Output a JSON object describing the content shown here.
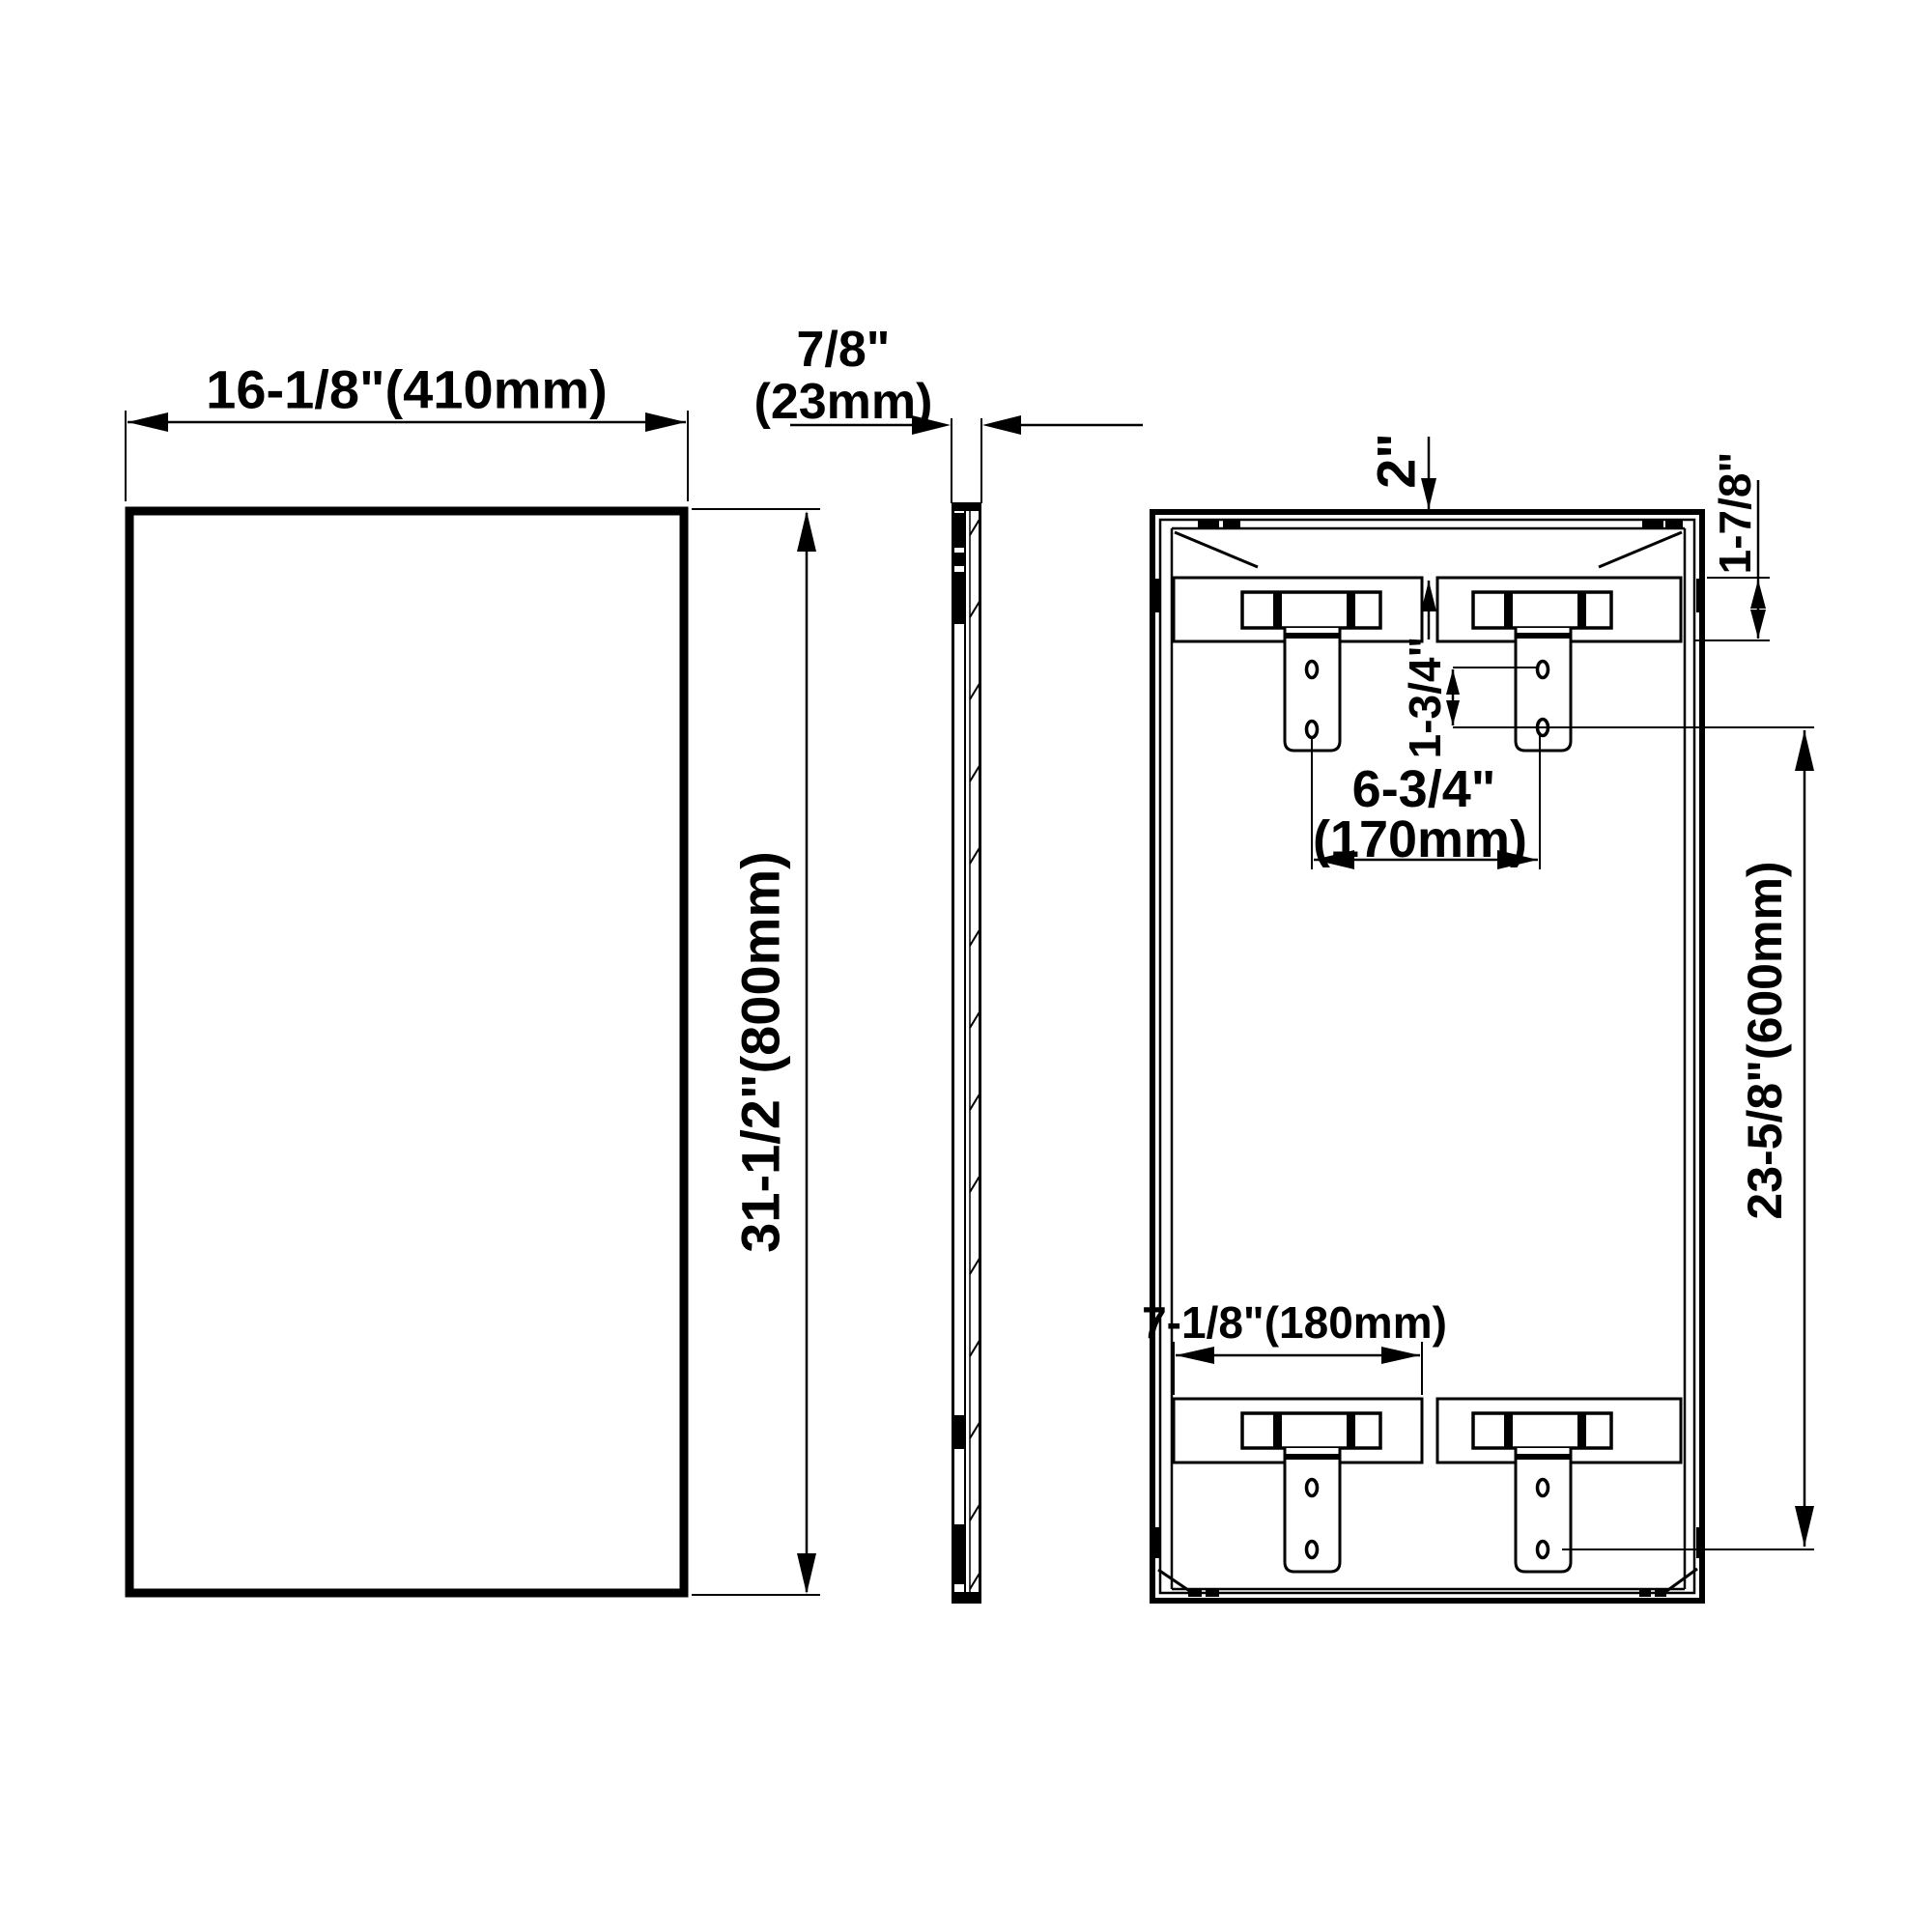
{
  "drawing": {
    "title": "Mirror three-view dimension drawing",
    "colors": {
      "line": "#000000",
      "background": "#ffffff"
    },
    "views": {
      "front": {
        "width_label": "16-1/8\"(410mm)",
        "height_label": "31-1/2\"(800mm)"
      },
      "side": {
        "depth_label_in": "7/8\"",
        "depth_label_mm": "(23mm)"
      },
      "back": {
        "top_offset_label": "2\"",
        "bracket_height_label": "1-7/8\"",
        "hole_spacing_label": "1-3/4\"",
        "top_bracket_spacing_in": "6-3/4\"",
        "top_bracket_spacing_mm": "(170mm)",
        "bottom_bracket_width_label": "7-1/8\"(180mm)",
        "mounting_height_label": "23-5/8\"(600mm)"
      }
    }
  }
}
